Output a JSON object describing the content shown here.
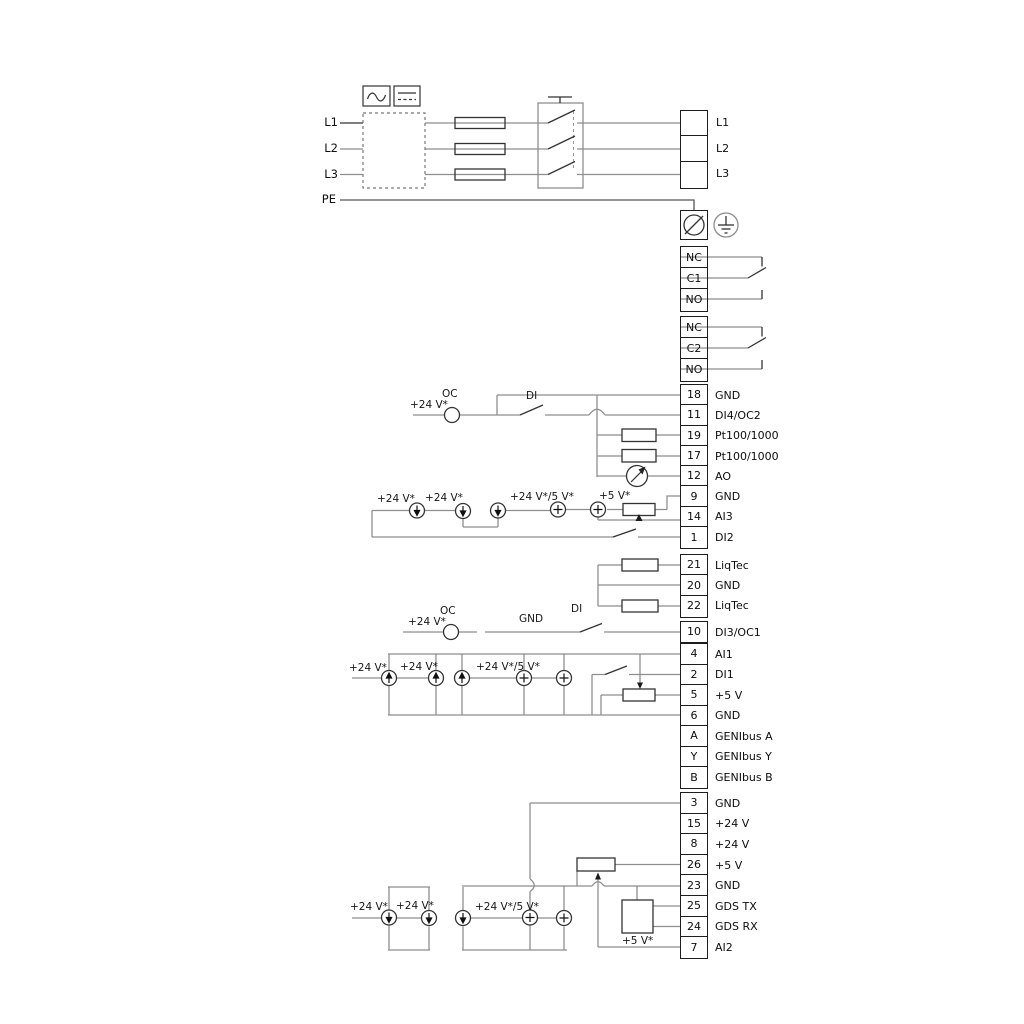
{
  "power": {
    "inputs": [
      "L1",
      "L2",
      "L3",
      "PE"
    ],
    "output_terminals": [
      "L1",
      "L2",
      "L3"
    ]
  },
  "relay1": {
    "rows": [
      "NC",
      "C1",
      "NO"
    ]
  },
  "relay2": {
    "rows": [
      "NC",
      "C2",
      "NO"
    ]
  },
  "io_top": {
    "rows": [
      {
        "num": "18",
        "label": "GND"
      },
      {
        "num": "11",
        "label": "DI4/OC2"
      },
      {
        "num": "19",
        "label": "Pt100/1000"
      },
      {
        "num": "17",
        "label": "Pt100/1000"
      },
      {
        "num": "12",
        "label": "AO"
      },
      {
        "num": "9",
        "label": "GND"
      },
      {
        "num": "14",
        "label": "AI3"
      },
      {
        "num": "1",
        "label": "DI2"
      }
    ]
  },
  "liqtec": {
    "rows": [
      {
        "num": "21",
        "label": "LiqTec"
      },
      {
        "num": "20",
        "label": "GND"
      },
      {
        "num": "22",
        "label": "LiqTec"
      }
    ]
  },
  "di3": {
    "rows": [
      {
        "num": "10",
        "label": "DI3/OC1"
      }
    ]
  },
  "io_mid": {
    "rows": [
      {
        "num": "4",
        "label": "AI1"
      },
      {
        "num": "2",
        "label": "DI1"
      },
      {
        "num": "5",
        "label": "+5 V"
      },
      {
        "num": "6",
        "label": "GND"
      },
      {
        "num": "A",
        "label": "GENIbus A"
      },
      {
        "num": "Y",
        "label": "GENIbus Y"
      },
      {
        "num": "B",
        "label": "GENIbus B"
      }
    ]
  },
  "io_bottom": {
    "rows": [
      {
        "num": "3",
        "label": "GND"
      },
      {
        "num": "15",
        "label": "+24 V"
      },
      {
        "num": "8",
        "label": "+24 V"
      },
      {
        "num": "26",
        "label": "+5 V"
      },
      {
        "num": "23",
        "label": "GND"
      },
      {
        "num": "25",
        "label": "GDS TX"
      },
      {
        "num": "24",
        "label": "GDS RX"
      },
      {
        "num": "7",
        "label": "AI2"
      }
    ]
  },
  "annotations": {
    "plus24": "+24 V*",
    "plus24or5": "+24 V*/5 V*",
    "plus5": "+5 V*",
    "oc": "OC",
    "di": "DI",
    "gnd": "GND"
  }
}
